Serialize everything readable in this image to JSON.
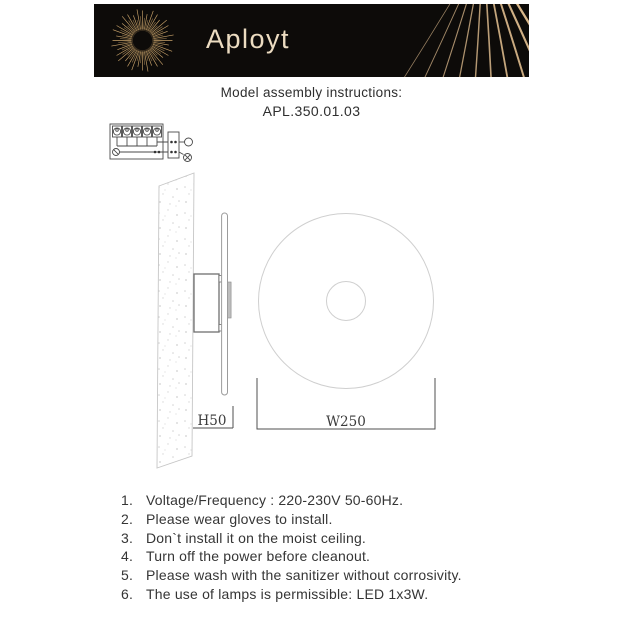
{
  "brand": {
    "logo_text": "Aployt"
  },
  "header": {
    "title": "Model assembly instructions:",
    "model": "APL.350.01.03"
  },
  "diagram": {
    "side_dimension_label": "H50",
    "front_dimension_label": "W250"
  },
  "instructions": [
    {
      "num": "1.",
      "text": "Voltage/Frequency : 220-230V 50-60Hz."
    },
    {
      "num": "2.",
      "text": "Please wear gloves to install."
    },
    {
      "num": "3.",
      "text": "Don`t install it on the moist ceiling."
    },
    {
      "num": "4.",
      "text": "Turn off the power before cleanout."
    },
    {
      "num": "5.",
      "text": "Please wash with the sanitizer without corrosivity."
    },
    {
      "num": "6.",
      "text": "The use of lamps is permissible: LED 1x3W."
    }
  ],
  "colors": {
    "accent_gold": "#C9A36A",
    "header_bg": "#0D0B09",
    "body_text": "#353535"
  }
}
